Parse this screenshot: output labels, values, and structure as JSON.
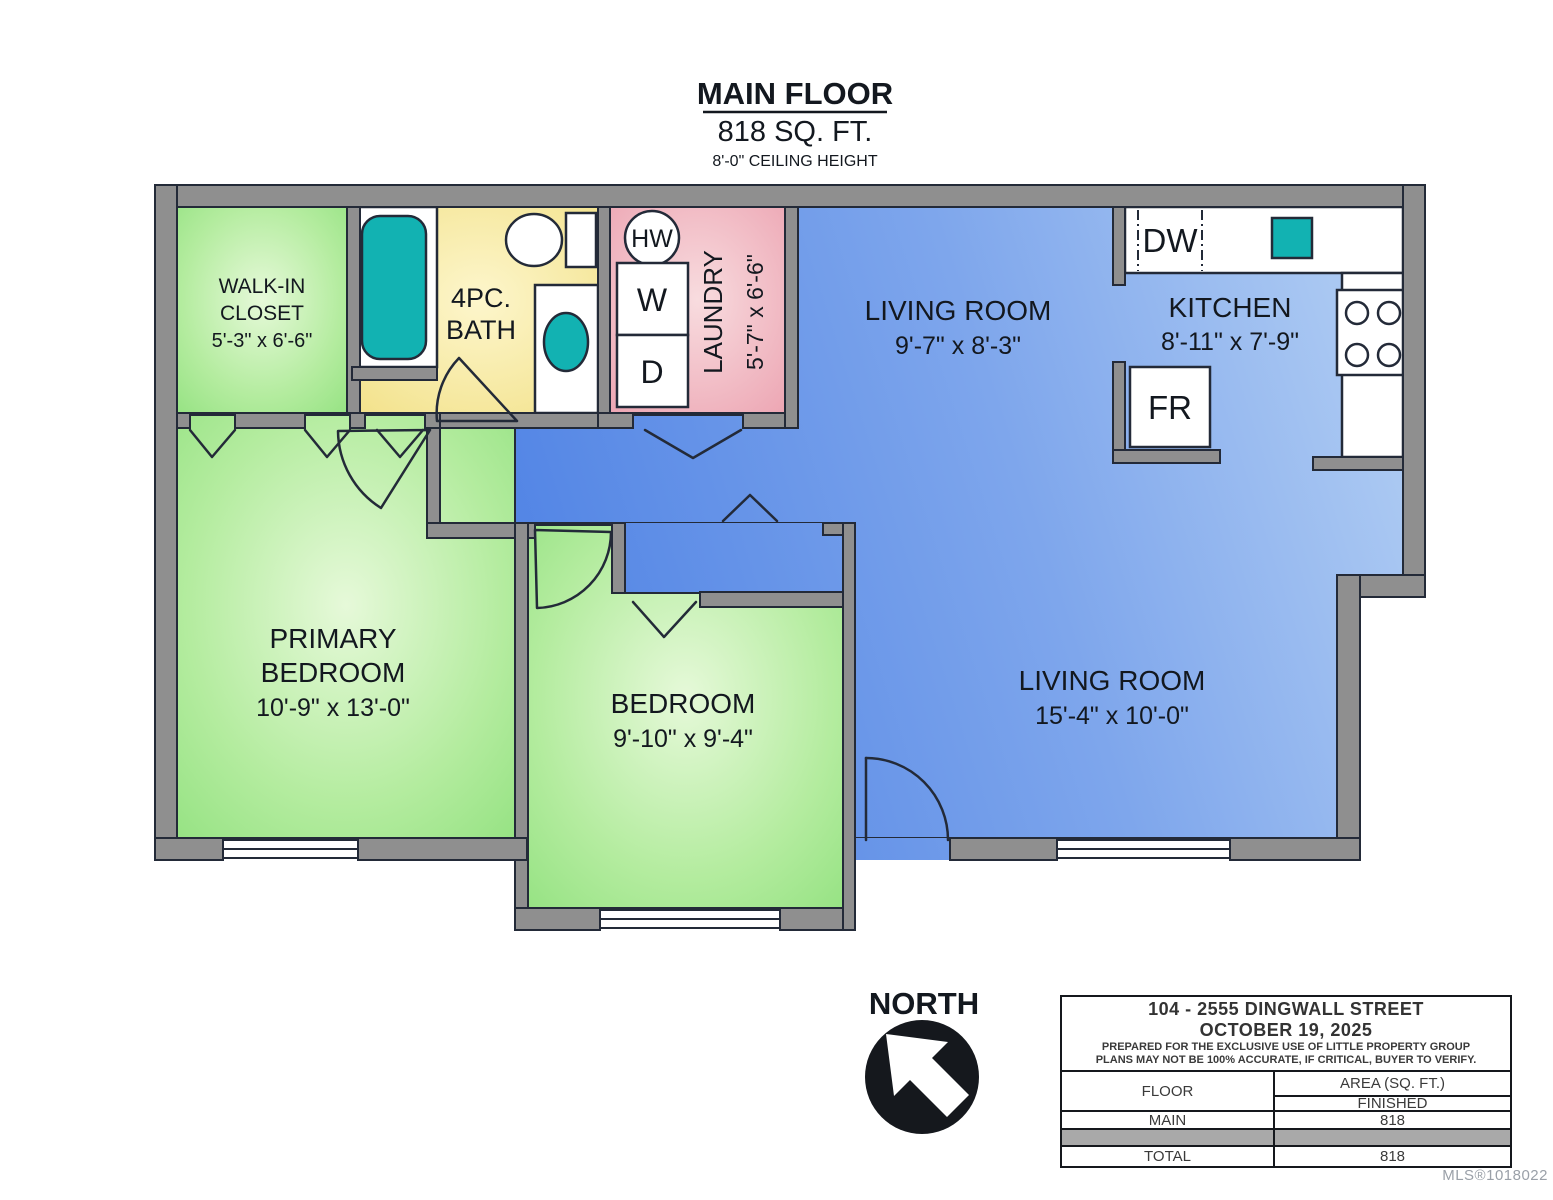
{
  "title": {
    "name": "MAIN FLOOR",
    "area": "818 SQ. FT.",
    "ceiling": "8'-0\" CEILING HEIGHT"
  },
  "compass": {
    "label": "NORTH"
  },
  "rooms": {
    "walk_in_closet": {
      "line1": "WALK-IN",
      "line2": "CLOSET",
      "dims": "5'-3\" x 6'-6\""
    },
    "bath": {
      "line1": "4PC.",
      "line2": "BATH"
    },
    "laundry": {
      "name": "LAUNDRY",
      "dims": "5'-7\" x 6'-6\""
    },
    "living_room_front": {
      "name": "LIVING ROOM",
      "dims": "9'-7\" x 8'-3\""
    },
    "kitchen": {
      "name": "KITCHEN",
      "dims": "8'-11\" x 7'-9\""
    },
    "primary_bedroom": {
      "line1": "PRIMARY",
      "line2": "BEDROOM",
      "dims": "10'-9\" x 13'-0\""
    },
    "bedroom": {
      "name": "BEDROOM",
      "dims": "9'-10\" x 9'-4\""
    },
    "living_room_main": {
      "name": "LIVING ROOM",
      "dims": "15'-4\" x 10'-0\""
    }
  },
  "fixtures": {
    "hot_water_tank": "HW",
    "washer": "W",
    "dryer": "D",
    "dishwasher": "DW",
    "fridge": "FR"
  },
  "info_table": {
    "address": "104 - 2555 DINGWALL STREET",
    "date": "OCTOBER 19, 2025",
    "disclaimer1": "PREPARED FOR THE EXCLUSIVE USE OF LITTLE PROPERTY GROUP",
    "disclaimer2": "PLANS MAY NOT BE 100% ACCURATE, IF CRITICAL, BUYER TO VERIFY.",
    "col_floor": "FLOOR",
    "col_area": "AREA (SQ. FT.)",
    "col_finished": "FINISHED",
    "row_main_label": "MAIN",
    "row_main_value": "818",
    "row_total_label": "TOTAL",
    "row_total_value": "818"
  },
  "watermark": "MLS®1018022",
  "colors": {
    "wall": "#8f8f8f",
    "outline": "#232a38",
    "fixture_teal": "#12b2b2",
    "floor_blue_deep": "#4c80e4",
    "floor_blue_light": "#b7d2f4",
    "floor_green": "#98e287",
    "floor_yellow": "#f3e38a",
    "floor_pink": "#eda9b6",
    "table_gray": "#a9a9a9"
  }
}
